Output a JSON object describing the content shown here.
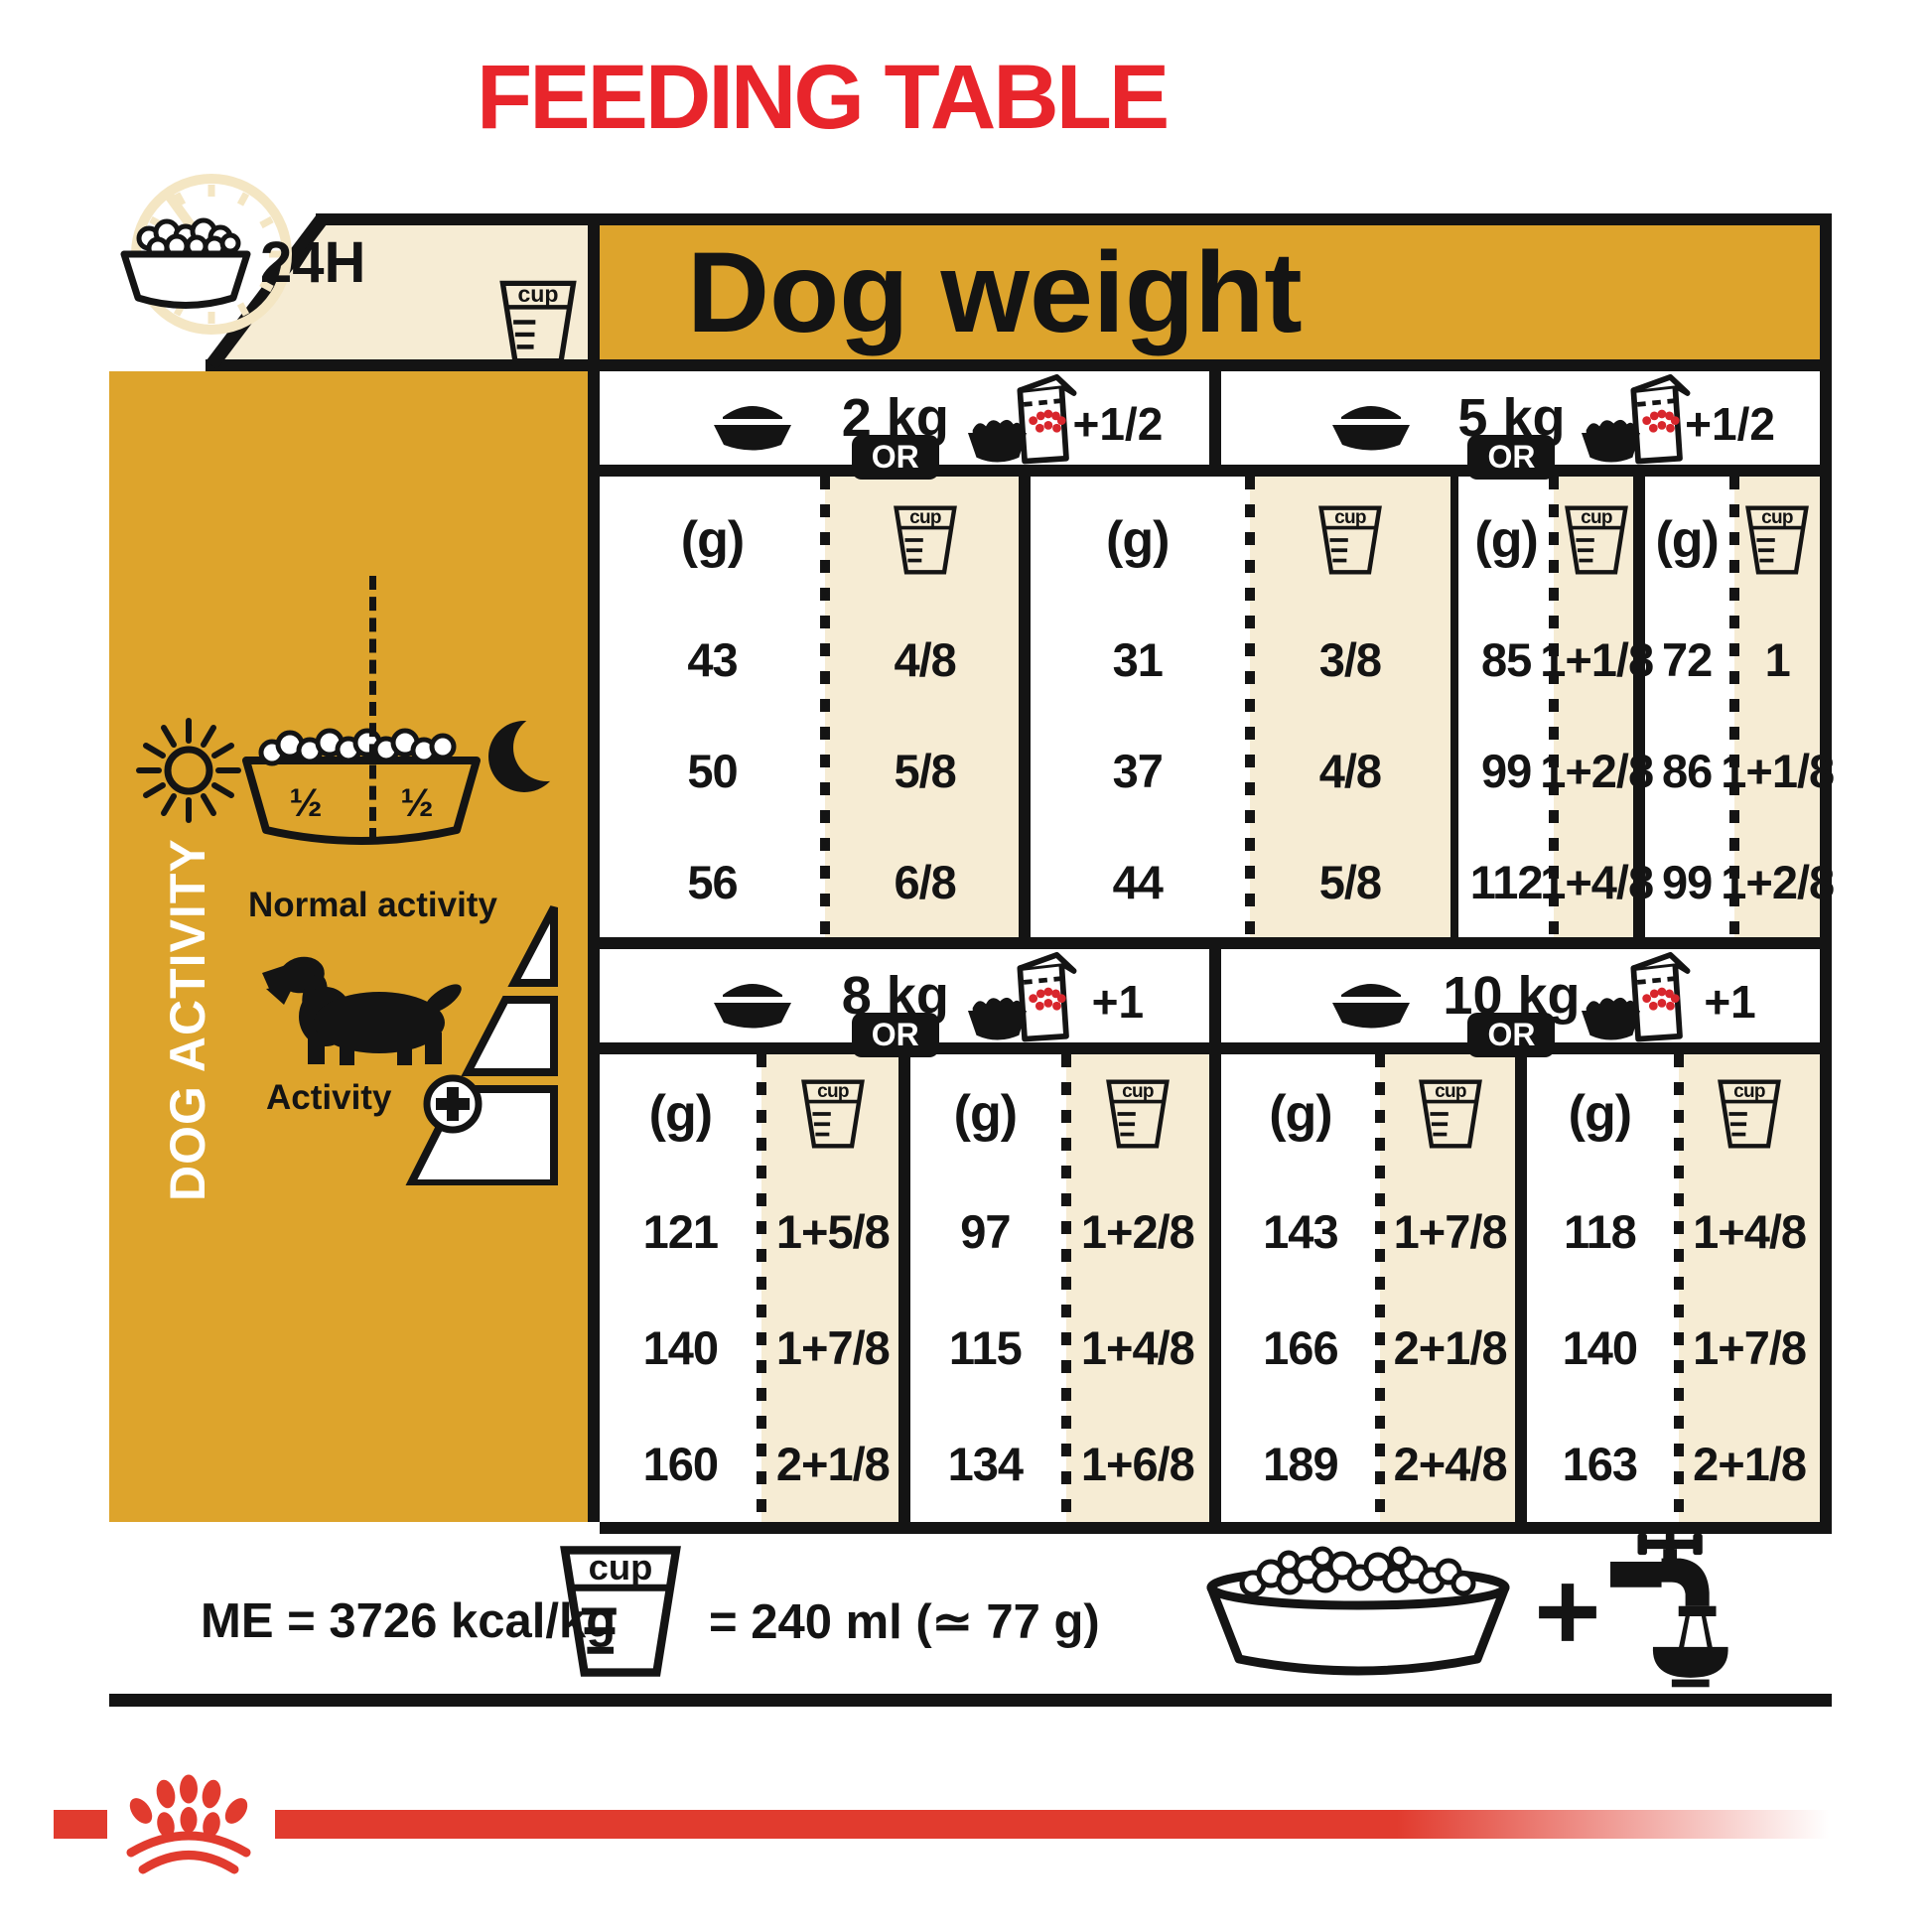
{
  "title": "FEEDING TABLE",
  "colors": {
    "gold": "#dda42c",
    "cream": "#f6ecd4",
    "title_red": "#e8252b",
    "logo_red": "#e13b2e",
    "wet_dots_red": "#d8262c",
    "ink": "#141414"
  },
  "corner": {
    "time_label": "24H",
    "cup_label": "cup"
  },
  "table": {
    "header": "Dog weight",
    "or_label": "OR",
    "col_g": "(g)",
    "col_cup": "cup",
    "sections": [
      {
        "weight": "2 kg",
        "wet_label": "+1/2",
        "dry": {
          "g": [
            43,
            50,
            56
          ],
          "cup": [
            "4/8",
            "5/8",
            "6/8"
          ]
        },
        "wet": {
          "g": [
            31,
            37,
            44
          ],
          "cup": [
            "3/8",
            "4/8",
            "5/8"
          ]
        }
      },
      {
        "weight": "5 kg",
        "wet_label": "+1/2",
        "dry": {
          "g": [
            85,
            99,
            112
          ],
          "cup": [
            "1+1/8",
            "1+2/8",
            "1+4/8"
          ]
        },
        "wet": {
          "g": [
            72,
            86,
            99
          ],
          "cup": [
            "1",
            "1+1/8",
            "1+2/8"
          ]
        }
      },
      {
        "weight": "8 kg",
        "wet_label": "+1",
        "dry": {
          "g": [
            121,
            140,
            160
          ],
          "cup": [
            "1+5/8",
            "1+7/8",
            "2+1/8"
          ]
        },
        "wet": {
          "g": [
            97,
            115,
            134
          ],
          "cup": [
            "1+2/8",
            "1+4/8",
            "1+6/8"
          ]
        }
      },
      {
        "weight": "10 kg",
        "wet_label": "+1",
        "dry": {
          "g": [
            143,
            166,
            189
          ],
          "cup": [
            "1+7/8",
            "2+1/8",
            "2+4/8"
          ]
        },
        "wet": {
          "g": [
            118,
            140,
            163
          ],
          "cup": [
            "1+4/8",
            "1+7/8",
            "2+1/8"
          ]
        }
      }
    ]
  },
  "sidebar": {
    "vertical_label": "DOG ACTIVITY",
    "half": "½",
    "normal_activity": "Normal activity",
    "activity": "Activity"
  },
  "footer": {
    "energy": "ME = 3726 kcal/kg",
    "cup_label": "cup",
    "cup_equiv": "= 240 ml (≃ 77 g)"
  },
  "icons": [
    "kibble-bowl",
    "measuring-cup",
    "24h-dial",
    "wet-pouch-bowl",
    "sun",
    "moon",
    "half-half-bowl",
    "dog-silhouette",
    "activity-plus",
    "activity-triangle",
    "bowl-plus-water-tap",
    "royal-canin-paw"
  ]
}
